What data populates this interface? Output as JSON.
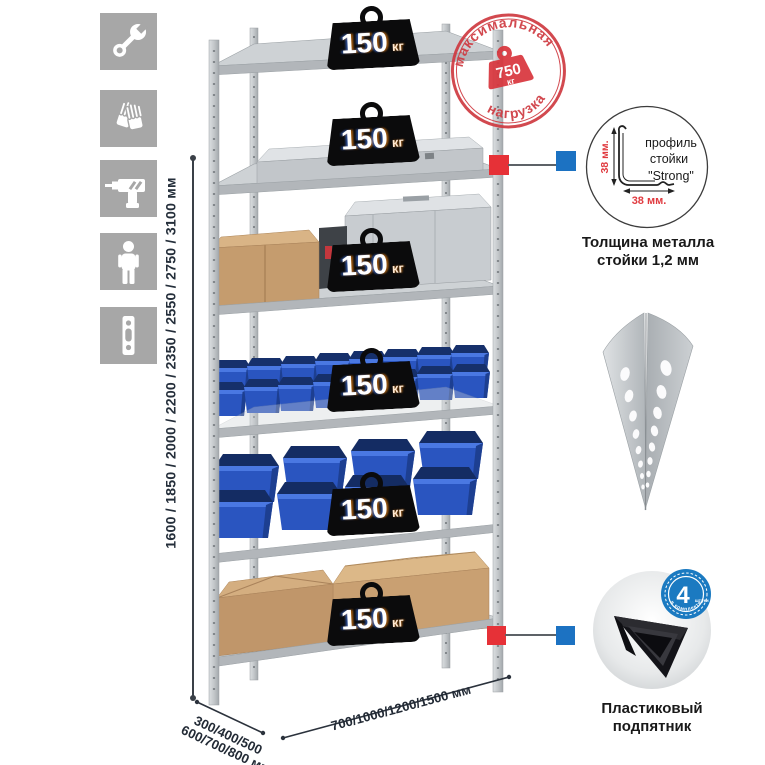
{
  "icons": {
    "items": [
      "wrench",
      "gloves",
      "drill",
      "person",
      "rack-post"
    ]
  },
  "dimensions": {
    "height": "1600 / 1850 / 2000 / 2200 / 2350 / 2550 / 2750 / 3100 мм",
    "depth_line1": "300/400/500",
    "depth_line2": "600/700/800 мм",
    "width": "700/1000/1200/1500 мм"
  },
  "rack": {
    "shelves_count": 6,
    "shelf_load": {
      "value": "150",
      "unit": "кг"
    }
  },
  "max_load_stamp": {
    "arc_top": "максимальная",
    "arc_bottom": "нагрузка",
    "value": "750",
    "unit": "кг"
  },
  "profile_detail": {
    "label_line1": "профиль",
    "label_line2": "стойки",
    "label_line3": "\"Strong\"",
    "dim_vertical": "38 мм.",
    "dim_horizontal": "38 мм.",
    "caption_line1": "Толщина металла",
    "caption_line2": "стойки 1,2 мм"
  },
  "post_image": {
    "name": "perforated-angle-post"
  },
  "foot_detail": {
    "badge_value": "4",
    "badge_unit": "штуки",
    "badge_arc": "в комплекте",
    "caption_line1": "Пластиковый",
    "caption_line2": "подпятник"
  },
  "colors": {
    "accent_red": "#e63137",
    "accent_blue": "#1c72c2",
    "stamp_red": "#cf3a41",
    "icon_bg": "#a7a7a7",
    "bin_blue": "#2a55c0"
  }
}
